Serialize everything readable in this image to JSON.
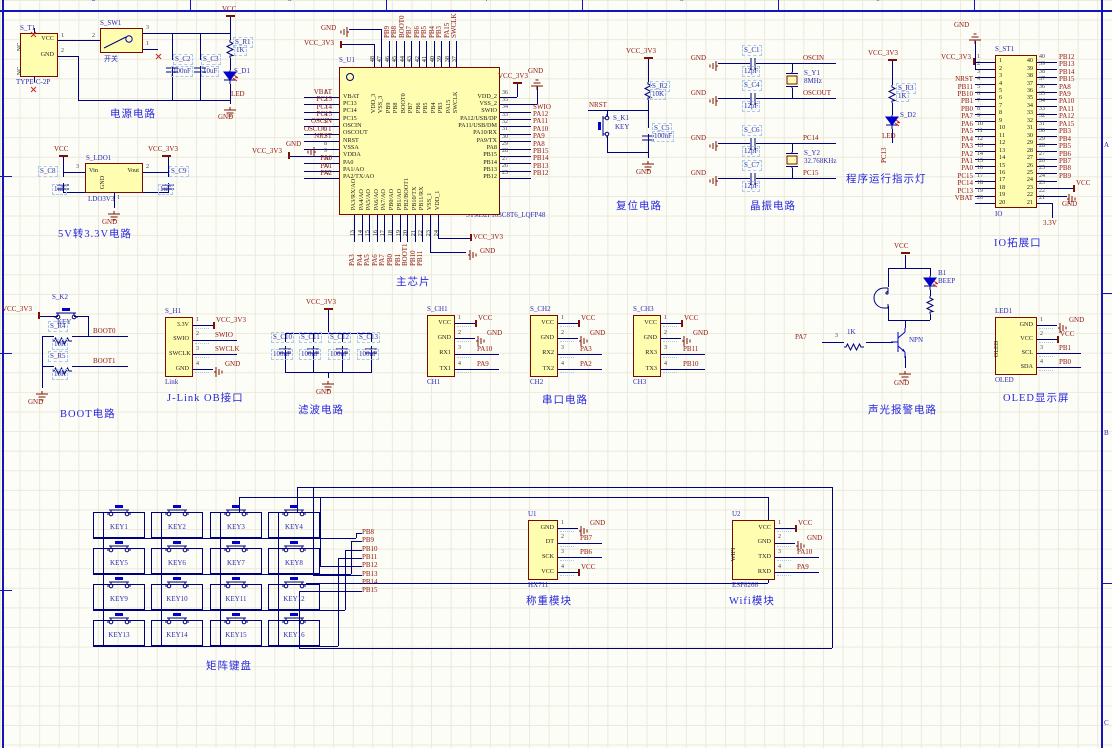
{
  "colors": {
    "wire": "#00007f",
    "net_label": "#8f1309",
    "designator": "#2a2ab2",
    "title": "#2727dd",
    "component_body": "#fffdb0",
    "component_border": "#7b0b00",
    "power_symbol": "#7c1205"
  },
  "sheet": {
    "columns": [
      "2",
      "3",
      "4",
      "5",
      "6"
    ],
    "zone_letters": [
      "A",
      "B",
      "C"
    ]
  },
  "titles": {
    "power": "电源电路",
    "ldo": "5V转3.3V电路",
    "mcu": "主芯片",
    "reset": "复位电路",
    "crystal": "晶振电路",
    "indicator": "程序运行指示灯",
    "io": "IO拓展口",
    "boot": "BOOT电路",
    "jlink": "J-Link OB接口",
    "filter": "滤波电路",
    "uart": "串口电路",
    "alarm": "声光报警电路",
    "oled": "OLED显示屏",
    "matrix": "矩阵键盘",
    "weigh": "称重模块",
    "wifi": "Wifi模块"
  },
  "power": {
    "t1": {
      "des": "S_T1",
      "part": "TYPE-C-2P",
      "pin_vcc": "VCC",
      "pin_gnd": "GND",
      "nc": "NC",
      "n1": "1",
      "n2": "2"
    },
    "sw": {
      "des": "S_SW1",
      "value": "开关",
      "n1": "1",
      "n2": "2",
      "n3": "3"
    },
    "c2": {
      "des": "S_C2",
      "value": "100nF"
    },
    "c3": {
      "des": "S_C3",
      "value": "10uF"
    },
    "r1": {
      "des": "S_R1",
      "value": "1K"
    },
    "d1": {
      "des": "S_D1",
      "value": "LED"
    },
    "vcc": "VCC",
    "gnd": "GND"
  },
  "ldo": {
    "des": "S_LDO1",
    "part": "LDO3V3",
    "vin": "Vin",
    "vout": "Vout",
    "gnd_pin": "GND",
    "n1": "1",
    "n2": "2",
    "n3": "3",
    "c8": {
      "des": "S_C8",
      "value": "1uF"
    },
    "c9": {
      "des": "S_C9",
      "value": "1uF"
    },
    "vcc": "VCC",
    "vcc33": "VCC_3V3",
    "gnd": "GND"
  },
  "mcu": {
    "des": "S_U1",
    "part": "STM32F103C8T6_LQFP48",
    "left": [
      {
        "n": "1",
        "name": "VBAT",
        "label": "VBAT",
        "t": "net"
      },
      {
        "n": "2",
        "name": "PC13",
        "label": "PC13",
        "t": "net"
      },
      {
        "n": "3",
        "name": "PC14",
        "label": "PC14",
        "t": "net"
      },
      {
        "n": "4",
        "name": "PC15",
        "label": "PC15",
        "t": "net"
      },
      {
        "n": "5",
        "name": "OSCIN",
        "label": "OSCIN",
        "t": "net"
      },
      {
        "n": "6",
        "name": "OSCOUT",
        "label": "OSCOUT",
        "t": "net"
      },
      {
        "n": "7",
        "name": "NRST",
        "label": "NRST",
        "t": "net"
      },
      {
        "n": "8",
        "name": "VSSA",
        "label": "GND",
        "t": "gnd"
      },
      {
        "n": "9",
        "name": "VDDA",
        "label": "VCC_3V3",
        "t": "vcc"
      },
      {
        "n": "10",
        "name": "PA0",
        "label": "PA0",
        "t": "net"
      },
      {
        "n": "11",
        "name": "PA1/AO",
        "label": "PA1",
        "t": "net"
      },
      {
        "n": "12",
        "name": "PA2/TX/AO",
        "label": "PA2",
        "t": "net"
      }
    ],
    "right": [
      {
        "n": "36",
        "name": "VDD_2",
        "label": "VCC_3V3",
        "t": "vcc-up"
      },
      {
        "n": "35",
        "name": "VSS_2",
        "label": "GND",
        "t": "gnd-up"
      },
      {
        "n": "34",
        "name": "SWIO",
        "label": "SWIO",
        "t": "net"
      },
      {
        "n": "33",
        "name": "PA12/USB/DP",
        "label": "PA12",
        "t": "net"
      },
      {
        "n": "32",
        "name": "PA11/USB/DM",
        "label": "PA11",
        "t": "net"
      },
      {
        "n": "31",
        "name": "PA10/RX",
        "label": "PA10",
        "t": "net"
      },
      {
        "n": "30",
        "name": "PA9/TX",
        "label": "PA9",
        "t": "net"
      },
      {
        "n": "29",
        "name": "PA8",
        "label": "PA8",
        "t": "net"
      },
      {
        "n": "28",
        "name": "PB15",
        "label": "PB15",
        "t": "net"
      },
      {
        "n": "27",
        "name": "PB14",
        "label": "PB14",
        "t": "net"
      },
      {
        "n": "26",
        "name": "PB13",
        "label": "PB13",
        "t": "net"
      },
      {
        "n": "25",
        "name": "PB12",
        "label": "PB12",
        "t": "net"
      }
    ],
    "top": [
      {
        "n": "48",
        "name": "VDD_3",
        "label": "VCC_3V3",
        "t": "vcc-elbow"
      },
      {
        "n": "47",
        "name": "VSS_3",
        "label": "GND",
        "t": "gnd-elbow"
      },
      {
        "n": "46",
        "name": "PB9",
        "label": "PB9",
        "t": "net"
      },
      {
        "n": "45",
        "name": "PB8",
        "label": "PB8",
        "t": "net"
      },
      {
        "n": "44",
        "name": "BOOT0",
        "label": "BOOT0",
        "t": "net"
      },
      {
        "n": "43",
        "name": "PB7",
        "label": "PB7",
        "t": "net"
      },
      {
        "n": "42",
        "name": "PB6",
        "label": "PB6",
        "t": "net"
      },
      {
        "n": "41",
        "name": "PB5",
        "label": "PB5",
        "t": "net"
      },
      {
        "n": "40",
        "name": "PB4",
        "label": "PB4",
        "t": "net"
      },
      {
        "n": "39",
        "name": "PB3",
        "label": "PB3",
        "t": "net"
      },
      {
        "n": "38",
        "name": "PA15",
        "label": "PA15",
        "t": "net"
      },
      {
        "n": "37",
        "name": "SWCLK",
        "label": "SWCLK",
        "t": "net"
      }
    ],
    "bottom": [
      {
        "n": "13",
        "name": "PA3/RX/AO",
        "label": "PA3",
        "t": "net"
      },
      {
        "n": "14",
        "name": "PA4/AO",
        "label": "PA4",
        "t": "net"
      },
      {
        "n": "15",
        "name": "PA5/AO",
        "label": "PA5",
        "t": "net"
      },
      {
        "n": "16",
        "name": "PA6/AO",
        "label": "PA6",
        "t": "net"
      },
      {
        "n": "17",
        "name": "PA7/AO",
        "label": "PA7",
        "t": "net"
      },
      {
        "n": "18",
        "name": "PB0/AO",
        "label": "PB0",
        "t": "net"
      },
      {
        "n": "19",
        "name": "PB1/AO",
        "label": "PB1",
        "t": "net"
      },
      {
        "n": "20",
        "name": "PB2/BOOT1",
        "label": "BOOT1",
        "t": "net"
      },
      {
        "n": "21",
        "name": "PB10/TX",
        "label": "PB10",
        "t": "net"
      },
      {
        "n": "22",
        "name": "PB11/RX",
        "label": "PB11",
        "t": "net"
      },
      {
        "n": "23",
        "name": "VSS_1",
        "label": "GND",
        "t": "gnd-elbow"
      },
      {
        "n": "24",
        "name": "VDD_1",
        "label": "VCC_3V3",
        "t": "vcc-elbow"
      }
    ]
  },
  "reset": {
    "r2": {
      "des": "S_R2",
      "value": "10K"
    },
    "k1": {
      "des": "S_K1",
      "value": "KEY"
    },
    "c5": {
      "des": "S_C5",
      "value": "100nF"
    },
    "nrst": "NRST",
    "vcc33": "VCC_3V3",
    "gnd": "GND"
  },
  "crystal": {
    "rows": [
      {
        "des": "S_C1",
        "value": "12pF",
        "label": "OSCIN"
      },
      {
        "des": "S_C4",
        "value": "12pF",
        "label": "OSCOUT"
      },
      {
        "des": "S_C6",
        "value": "12pF",
        "label": "PC14"
      },
      {
        "des": "S_C7",
        "value": "12pF",
        "label": "PC15"
      }
    ],
    "y1": {
      "des": "S_Y1",
      "value": "8MHz"
    },
    "y2": {
      "des": "S_Y2",
      "value": "32.768KHz"
    },
    "gnd": "GND"
  },
  "indicator": {
    "r3": {
      "des": "S_R3",
      "value": "1K"
    },
    "d2": {
      "des": "S_D2",
      "value": "LED"
    },
    "net": "PC13",
    "vcc33": "VCC_3V3"
  },
  "io": {
    "des": "S_ST1",
    "part": "IO",
    "gnd_top": "GND",
    "left": [
      "VCC_3V3",
      "",
      "",
      "NRST",
      "PB11",
      "PB10",
      "PB1",
      "PB0",
      "PA7",
      "PA6",
      "PA5",
      "PA4",
      "PA3",
      "PA2",
      "PA1",
      "PA0",
      "PC15",
      "PC14",
      "PC13",
      "VBAT"
    ],
    "right": [
      "PB12",
      "PB13",
      "PB14",
      "PB15",
      "PA8",
      "PA9",
      "PA10",
      "PA11",
      "PA12",
      "PA15",
      "PB3",
      "PB4",
      "PB5",
      "PB6",
      "PB7",
      "PB8",
      "PB9",
      "VCC",
      "GND",
      "3.3V"
    ]
  },
  "boot": {
    "k2": {
      "des": "S_K2",
      "value": "KEY"
    },
    "r4": {
      "des": "S_R4",
      "value": "10K"
    },
    "r5": {
      "des": "S_R5",
      "value": "10K"
    },
    "boot0": "BOOT0",
    "boot1": "BOOT1",
    "vcc33": "VCC_3V3",
    "gnd": "GND"
  },
  "jlink": {
    "des": "S_H1",
    "part": "Link",
    "pins": [
      {
        "name": "3.3V",
        "n": "1",
        "label": "VCC_3V3",
        "t": "vcc"
      },
      {
        "name": "SWIO",
        "n": "2",
        "label": "SWIO",
        "t": "net"
      },
      {
        "name": "SWCLK",
        "n": "3",
        "label": "SWCLK",
        "t": "net"
      },
      {
        "name": "GND",
        "n": "4",
        "label": "GND",
        "t": "gnd"
      }
    ]
  },
  "filter": {
    "caps": [
      {
        "des": "S_C10",
        "value": "100nF"
      },
      {
        "des": "S_C11",
        "value": "100nF"
      },
      {
        "des": "S_C12",
        "value": "100nF"
      },
      {
        "des": "S_C13",
        "value": "100nF"
      }
    ],
    "vcc33": "VCC_3V3",
    "gnd": "GND"
  },
  "uart": {
    "ch1": {
      "des": "S_CH1",
      "part": "CH1",
      "pins": [
        {
          "name": "VCC",
          "n": "1",
          "label": "VCC",
          "t": "vcc"
        },
        {
          "name": "GND",
          "n": "2",
          "label": "GND",
          "t": "gnd"
        },
        {
          "name": "RX1",
          "n": "3",
          "label": "PA10",
          "t": "net"
        },
        {
          "name": "TX1",
          "n": "4",
          "label": "PA9",
          "t": "net"
        }
      ]
    },
    "ch2": {
      "des": "S_CH2",
      "part": "CH2",
      "pins": [
        {
          "name": "VCC",
          "n": "1",
          "label": "VCC",
          "t": "vcc"
        },
        {
          "name": "GND",
          "n": "2",
          "label": "GND",
          "t": "gnd"
        },
        {
          "name": "RX2",
          "n": "3",
          "label": "PA3",
          "t": "net"
        },
        {
          "name": "TX2",
          "n": "4",
          "label": "PA2",
          "t": "net"
        }
      ]
    },
    "ch3": {
      "des": "S_CH3",
      "part": "CH3",
      "pins": [
        {
          "name": "VCC",
          "n": "1",
          "label": "VCC",
          "t": "vcc"
        },
        {
          "name": "GND",
          "n": "2",
          "label": "GND",
          "t": "gnd"
        },
        {
          "name": "RX3",
          "n": "3",
          "label": "PB11",
          "t": "net"
        },
        {
          "name": "TX3",
          "n": "4",
          "label": "PB10",
          "t": "net"
        }
      ]
    }
  },
  "alarm": {
    "b1_des": "B1",
    "b1_value": "BEEP",
    "npn": "NPN",
    "res": "1K",
    "pin": "3",
    "net": "PA7",
    "vcc": "VCC",
    "gnd": "GND"
  },
  "oled": {
    "des": "LED1",
    "part": "OLED",
    "side": "OLED",
    "pins": [
      {
        "name": "GND",
        "n": "1",
        "label": "GND",
        "t": "gnd"
      },
      {
        "name": "VCC",
        "n": "2",
        "label": "VCC",
        "t": "vcc"
      },
      {
        "name": "SCL",
        "n": "3",
        "label": "PB1",
        "t": "net"
      },
      {
        "name": "SDA",
        "n": "4",
        "label": "PB0",
        "t": "net"
      }
    ]
  },
  "matrix": {
    "keys": [
      "KEY1",
      "KEY2",
      "KEY3",
      "KEY4",
      "KEY5",
      "KEY6",
      "KEY7",
      "KEY8",
      "KEY9",
      "KEY10",
      "KEY11",
      "KEY12",
      "KEY13",
      "KEY14",
      "KEY15",
      "KEY16"
    ],
    "labels": [
      "PB8",
      "PB9",
      "PB10",
      "PB11",
      "PB12",
      "PB13",
      "PB14",
      "PB15"
    ]
  },
  "weigh": {
    "des": "U1",
    "part": "HX711",
    "pins": [
      {
        "name": "GND",
        "n": "1",
        "label": "GND",
        "t": "gnd"
      },
      {
        "name": "DT",
        "n": "2",
        "label": "PB7",
        "t": "net"
      },
      {
        "name": "SCK",
        "n": "3",
        "label": "PB6",
        "t": "net"
      },
      {
        "name": "VCC",
        "n": "4",
        "label": "VCC",
        "t": "vcc"
      }
    ]
  },
  "wifi": {
    "des": "U2",
    "part": "ESP8266",
    "side": "WIFI",
    "pins": [
      {
        "name": "VCC",
        "n": "1",
        "label": "VCC",
        "t": "vcc"
      },
      {
        "name": "GND",
        "n": "2",
        "label": "GND",
        "t": "gnd"
      },
      {
        "name": "TXD",
        "n": "3",
        "label": "PA10",
        "t": "net"
      },
      {
        "name": "RXD",
        "n": "4",
        "label": "PA9",
        "t": "net"
      }
    ]
  }
}
